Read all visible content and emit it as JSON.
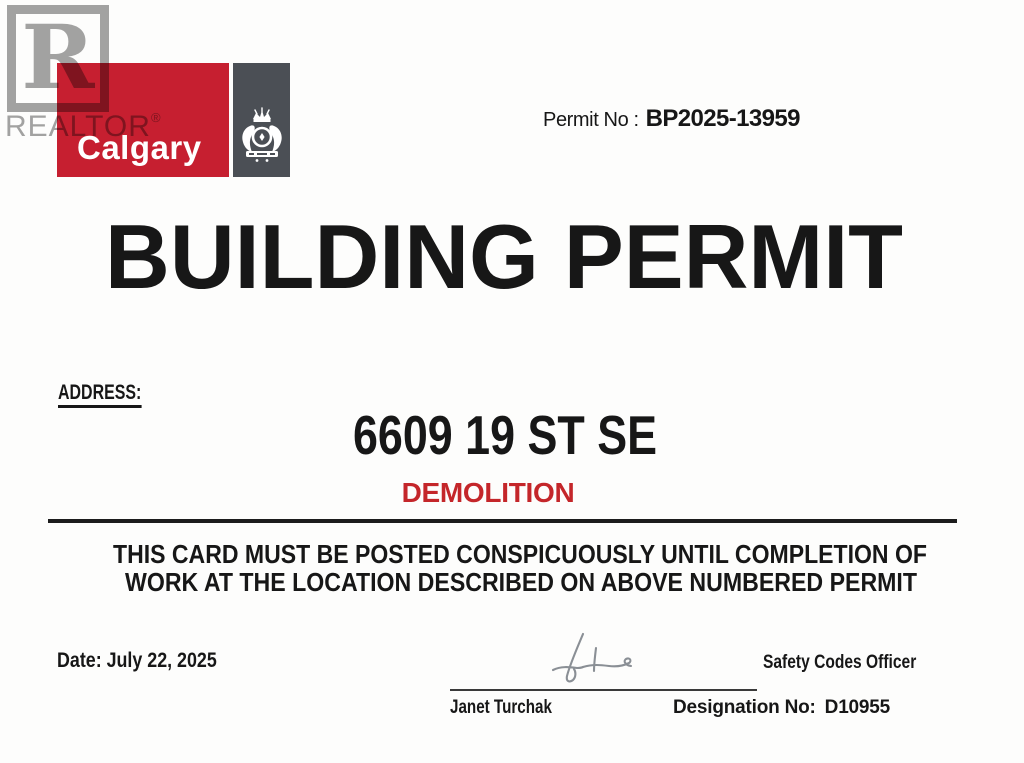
{
  "watermark": {
    "letter": "R",
    "label": "REALTOR",
    "reg_mark": "®"
  },
  "logo": {
    "city": "Calgary"
  },
  "permit": {
    "label": "Permit No :",
    "number": "BP2025-13959"
  },
  "title": "BUILDING PERMIT",
  "address": {
    "label": "ADDRESS:",
    "value": "6609 19 ST SE",
    "work_type": "DEMOLITION"
  },
  "notice": {
    "line1": "THIS CARD MUST BE POSTED CONSPICUOUSLY UNTIL COMPLETION OF",
    "line2": "WORK AT THE LOCATION DESCRIBED ON ABOVE NUMBERED PERMIT"
  },
  "footer": {
    "date_label": "Date:",
    "date_value": "July 22, 2025",
    "officer_title": "Safety Codes Officer",
    "officer_name": "Janet Turchak",
    "designation_label": "Designation No:",
    "designation_value": "D10955"
  },
  "colors": {
    "calgary_red": "#c61f30",
    "crest_gray": "#4b4f55",
    "demolition_red": "#c4262a",
    "watermark_gray": "#9b9b9b"
  }
}
